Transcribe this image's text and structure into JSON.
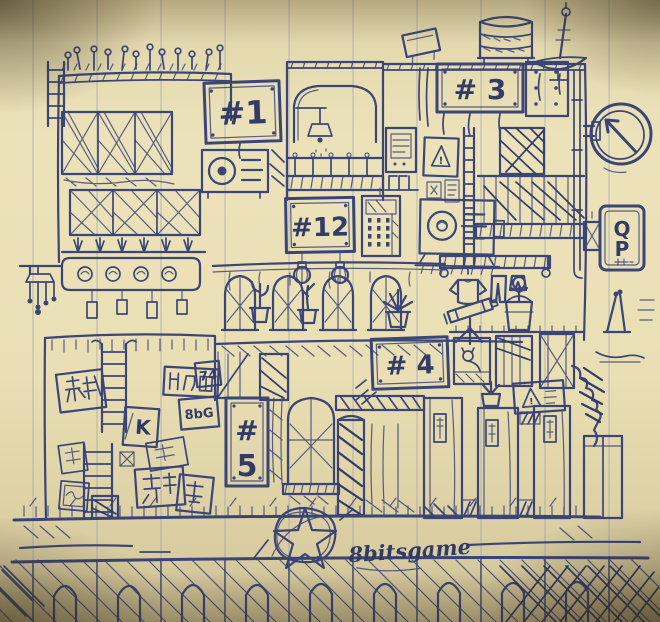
{
  "artwork": {
    "description": "hand-drawn blue ink sketch of a dense multi-story apartment building facade on lined notebook paper",
    "signature": "8bitsgame",
    "colors": {
      "ink": "#2e3b73",
      "ink_dark": "#243060",
      "paper": "#ebe1b8",
      "paper_edge": "#c9bc92",
      "ruled_line": "#7d8fae"
    }
  },
  "signs": {
    "unit1": "#1",
    "unit12": "#12",
    "unit3": "# 3",
    "unit4": "# 4",
    "unit5_hash": "#",
    "unit5_number": "5",
    "qp_top": "Q",
    "qp_bottom": "P",
    "poster_8bg": "8bG",
    "poster_k": "K",
    "poster_74": "74",
    "warning_mark": "!"
  }
}
